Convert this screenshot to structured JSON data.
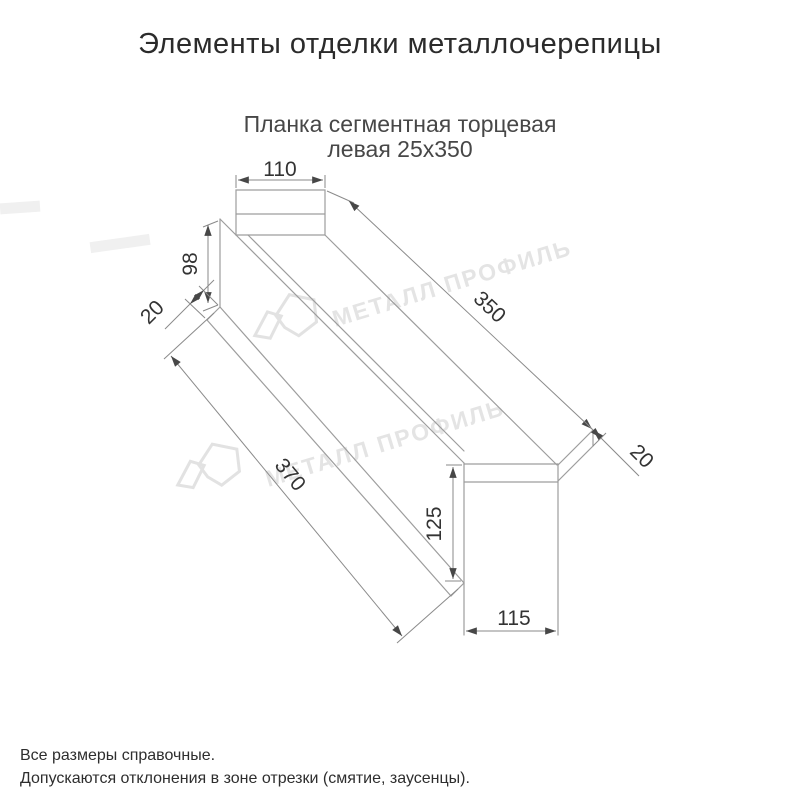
{
  "page": {
    "title": "Элементы отделки металлочерепицы"
  },
  "product": {
    "subtitle_line1": "Планка сегментная торцевая",
    "subtitle_line2": "левая 25х350"
  },
  "drawing": {
    "type": "dimensioned technical sketch, oblique 3D view of left segment verge strip",
    "dimensions": {
      "top_flange_width": "110",
      "left_end_height": "98",
      "left_fold": "20",
      "top_length": "350",
      "right_fold": "20",
      "front_length": "370",
      "end_height": "125",
      "end_width": "115"
    }
  },
  "watermark": {
    "text": "МЕТАЛЛ ПРОФИЛЬ"
  },
  "footnotes": {
    "line1": "Все размеры справочные.",
    "line2": "Допускаются отклонения в зоне отрезки (смятие, заусенцы)."
  },
  "colors": {
    "edge_line": "#9d9d9d",
    "dim_line": "#8a8a8a",
    "arrow": "#474747",
    "dim_text": "#333333",
    "title_text": "#2b2b2b",
    "watermark": "#e4e4e4"
  }
}
